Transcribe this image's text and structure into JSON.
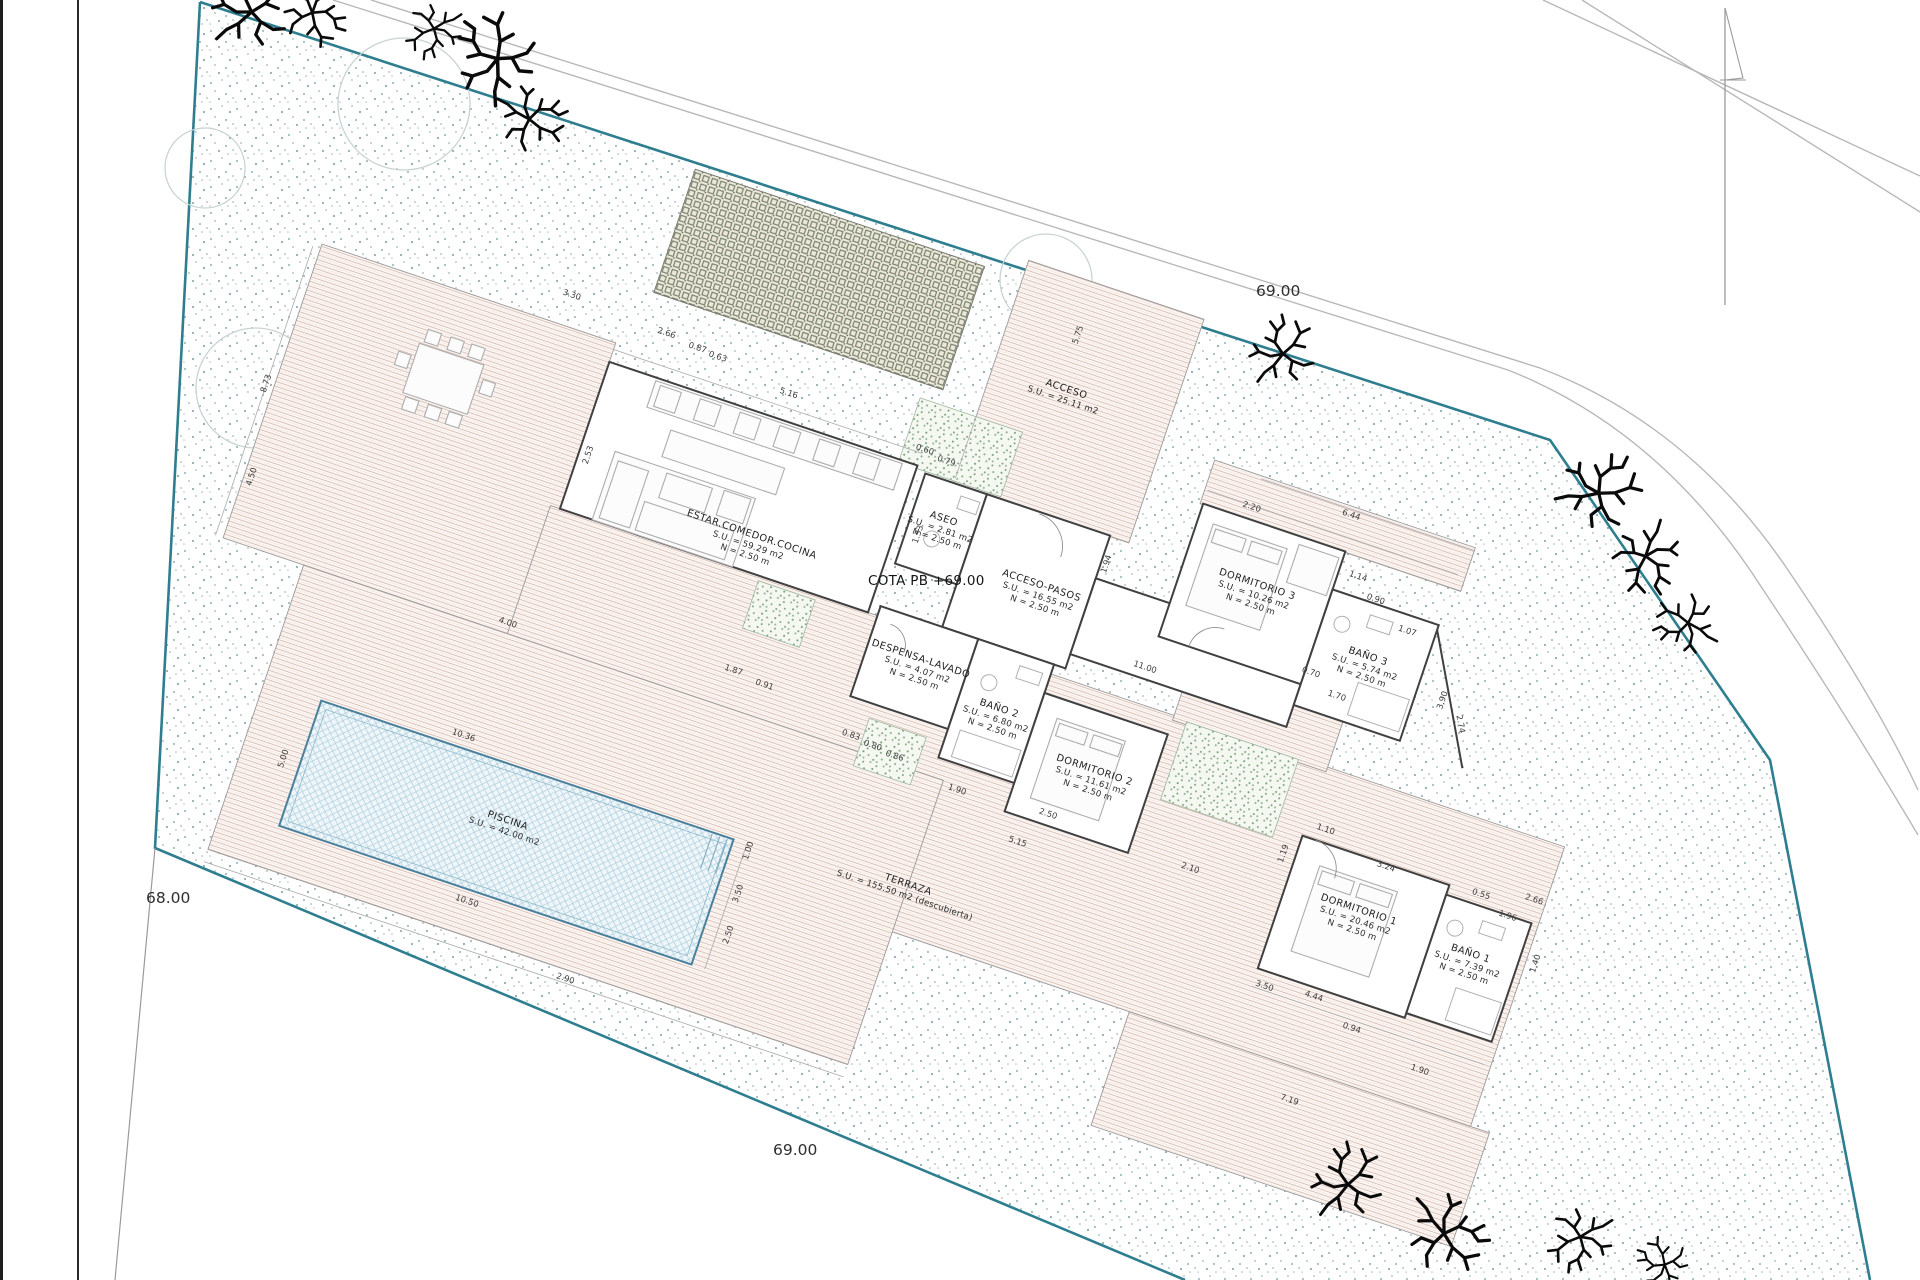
{
  "labels": {
    "cota": "COTA PB +69.00",
    "level_top": "69.00",
    "level_left": "68.00",
    "level_bottom": "69.00"
  },
  "rooms": [
    {
      "id": "estar",
      "name": "ESTAR.COMEDOR.COCINA",
      "l1": "S.U. = 59.29 m2",
      "l2": "N = 2.50 m",
      "u": 440,
      "v": 176
    },
    {
      "id": "aseo",
      "name": "ASEO",
      "l1": "S.U. = 2.81 m2",
      "l2": "N = 2.50 m",
      "u": 617,
      "v": 100
    },
    {
      "id": "acceso-pasos",
      "name": "ACCESO-PASOS",
      "l1": "S.U. = 16.55 m2",
      "l2": "N = 2.50 m",
      "u": 731,
      "v": 132
    },
    {
      "id": "despensa-lavado",
      "name": "DESPENSA-LAVADO",
      "l1": "S.U. = 4.07 m2",
      "l2": "N = 2.50 m",
      "u": 640,
      "v": 240
    },
    {
      "id": "bano-2",
      "name": "BAÑO 2",
      "l1": "S.U. = 6.80 m2",
      "l2": "N = 2.50 m",
      "u": 730,
      "v": 262
    },
    {
      "id": "dormitorio-2",
      "name": "DORMITORIO 2",
      "l1": "S.U. = 11.61 m2",
      "l2": "N = 2.50 m",
      "u": 840,
      "v": 290
    },
    {
      "id": "dormitorio-3",
      "name": "DORMITORIO 3",
      "l1": "S.U. = 10.26 m2",
      "l2": "N = 2.50 m",
      "u": 935,
      "v": 62
    },
    {
      "id": "bano-3",
      "name": "BAÑO 3",
      "l1": "S.U. = 5.74 m2",
      "l2": "N = 2.50 m",
      "u": 1063,
      "v": 95
    },
    {
      "id": "dormitorio-1",
      "name": "DORMITORIO 1",
      "l1": "S.U. = 20.46 m2",
      "l2": "N = 2.50 m",
      "u": 1135,
      "v": 338
    },
    {
      "id": "bano-1",
      "name": "BAÑO 1",
      "l1": "S.U. = 7.39 m2",
      "l2": "N = 2.50 m",
      "u": 1255,
      "v": 344
    },
    {
      "id": "piscina",
      "name": "PISCINA",
      "l1": "S.U. = 42.00 m2",
      "l2": "",
      "u": 300,
      "v": 525
    },
    {
      "id": "terraza",
      "name": "TERRAZA",
      "l1": "S.U. = 155.50 m2 (descubierta)",
      "l2": "",
      "u": 700,
      "v": 458
    },
    {
      "id": "acceso",
      "name": "ACCESO",
      "l1": "S.U. = 25.11 m2",
      "l2": "",
      "u": 692,
      "v": -62
    }
  ],
  "dims": [
    {
      "t": "3.30",
      "u": 193,
      "v": 6
    },
    {
      "t": "2.66",
      "u": 295,
      "v": 12
    },
    {
      "t": "0.87",
      "u": 329,
      "v": 16
    },
    {
      "t": "0.63",
      "u": 351,
      "v": 18
    },
    {
      "t": "0.60",
      "u": 577,
      "v": 40
    },
    {
      "t": "0.79",
      "u": 601,
      "v": 44
    },
    {
      "t": "5.16",
      "u": 430,
      "v": 30
    },
    {
      "t": "8.73",
      "u": -66,
      "v": 185,
      "r": -90
    },
    {
      "t": "4.50",
      "u": -50,
      "v": 278,
      "r": -90
    },
    {
      "t": "2.53",
      "u": 262,
      "v": 150,
      "r": -90
    },
    {
      "t": "4.00",
      "u": 237,
      "v": 337
    },
    {
      "t": "1.87",
      "u": 466,
      "v": 310
    },
    {
      "t": "0.91",
      "u": 500,
      "v": 314
    },
    {
      "t": "0.83",
      "u": 598,
      "v": 334
    },
    {
      "t": "0.80",
      "u": 622,
      "v": 337
    },
    {
      "t": "0.86",
      "u": 646,
      "v": 340
    },
    {
      "t": "1.90",
      "u": 716,
      "v": 352
    },
    {
      "t": "1.94",
      "u": 788,
      "v": 88,
      "r": -90
    },
    {
      "t": "1.33",
      "u": 600,
      "v": 120,
      "r": -90
    },
    {
      "t": "11.00",
      "u": 855,
      "v": 176
    },
    {
      "t": "2.20",
      "u": 905,
      "v": -10
    },
    {
      "t": "6.44",
      "u": 1002,
      "v": -34
    },
    {
      "t": "1.14",
      "u": 1028,
      "v": 22
    },
    {
      "t": "0.90",
      "u": 1052,
      "v": 38
    },
    {
      "t": "1.07",
      "u": 1092,
      "v": 58
    },
    {
      "t": "0.70",
      "u": 1014,
      "v": 128
    },
    {
      "t": "1.70",
      "u": 1046,
      "v": 142
    },
    {
      "t": "3.90",
      "u": 1150,
      "v": 110,
      "r": -90
    },
    {
      "t": "2.74",
      "u": 1170,
      "v": 128,
      "r": 61
    },
    {
      "t": "5.75",
      "u": 688,
      "v": -120,
      "r": -90
    },
    {
      "t": "2.50",
      "u": 810,
      "v": 346
    },
    {
      "t": "5.15",
      "u": 790,
      "v": 382
    },
    {
      "t": "2.10",
      "u": 962,
      "v": 352
    },
    {
      "t": "3.24",
      "u": 1147,
      "v": 288
    },
    {
      "t": "1.10",
      "u": 1078,
      "v": 272
    },
    {
      "t": "1.19",
      "u": 1048,
      "v": 306,
      "r": -90
    },
    {
      "t": "4.44",
      "u": 1120,
      "v": 434
    },
    {
      "t": "3.50",
      "u": 1070,
      "v": 440
    },
    {
      "t": "0.94",
      "u": 1166,
      "v": 452
    },
    {
      "t": "1.90",
      "u": 1244,
      "v": 470
    },
    {
      "t": "7.19",
      "u": 1130,
      "v": 540
    },
    {
      "t": "2.66",
      "u": 1298,
      "v": 272
    },
    {
      "t": "1.96",
      "u": 1278,
      "v": 296
    },
    {
      "t": "0.55",
      "u": 1246,
      "v": 284
    },
    {
      "t": "1.40",
      "u": 1322,
      "v": 330,
      "r": -90
    },
    {
      "t": "10.36",
      "u": 231,
      "v": 458
    },
    {
      "t": "10.50",
      "u": 287,
      "v": 614
    },
    {
      "t": "1.00",
      "u": 540,
      "v": 474,
      "r": -90
    },
    {
      "t": "3.50",
      "u": 544,
      "v": 518,
      "r": -90
    },
    {
      "t": "2.50",
      "u": 548,
      "v": 560,
      "r": -90
    },
    {
      "t": "5.00",
      "u": 70,
      "v": 535,
      "r": -90
    },
    {
      "t": "2.90",
      "u": 405,
      "v": 656
    }
  ],
  "site": {
    "trees": [
      {
        "x": 253,
        "y": 4,
        "s": 1.35,
        "r": 10
      },
      {
        "x": 318,
        "y": 16,
        "s": 1.1,
        "r": 120
      },
      {
        "x": 432,
        "y": 34,
        "s": 0.95,
        "r": 200
      },
      {
        "x": 492,
        "y": 52,
        "s": 1.45,
        "r": 320
      },
      {
        "x": 536,
        "y": 118,
        "s": 1.15,
        "r": 80
      },
      {
        "x": 1283,
        "y": 347,
        "s": 1.15,
        "r": 0
      },
      {
        "x": 1604,
        "y": 487,
        "s": 1.35,
        "r": 40
      },
      {
        "x": 1648,
        "y": 563,
        "s": 1.2,
        "r": 160
      },
      {
        "x": 1682,
        "y": 624,
        "s": 1.05,
        "r": 260
      },
      {
        "x": 1348,
        "y": 1177,
        "s": 1.25,
        "r": 0
      },
      {
        "x": 1452,
        "y": 1235,
        "s": 1.35,
        "r": 100
      },
      {
        "x": 1578,
        "y": 1243,
        "s": 1.1,
        "r": 200
      },
      {
        "x": 1660,
        "y": 1262,
        "s": 0.9,
        "r": 300
      }
    ],
    "canopies": [
      {
        "x": 256,
        "y": 388,
        "r": 60
      },
      {
        "x": 404,
        "y": 104,
        "r": 66
      },
      {
        "x": 1046,
        "y": 280,
        "r": 46
      },
      {
        "x": 205,
        "y": 168,
        "r": 40
      }
    ]
  },
  "colors": {
    "boundary": "#2e7e8f",
    "stipple": "#93b1b3",
    "terrace_hatch": "#d8bcb2",
    "pool_edge": "#4a809c",
    "court_grid": "#6d7b64",
    "green_speckle": "#7ca27c"
  }
}
